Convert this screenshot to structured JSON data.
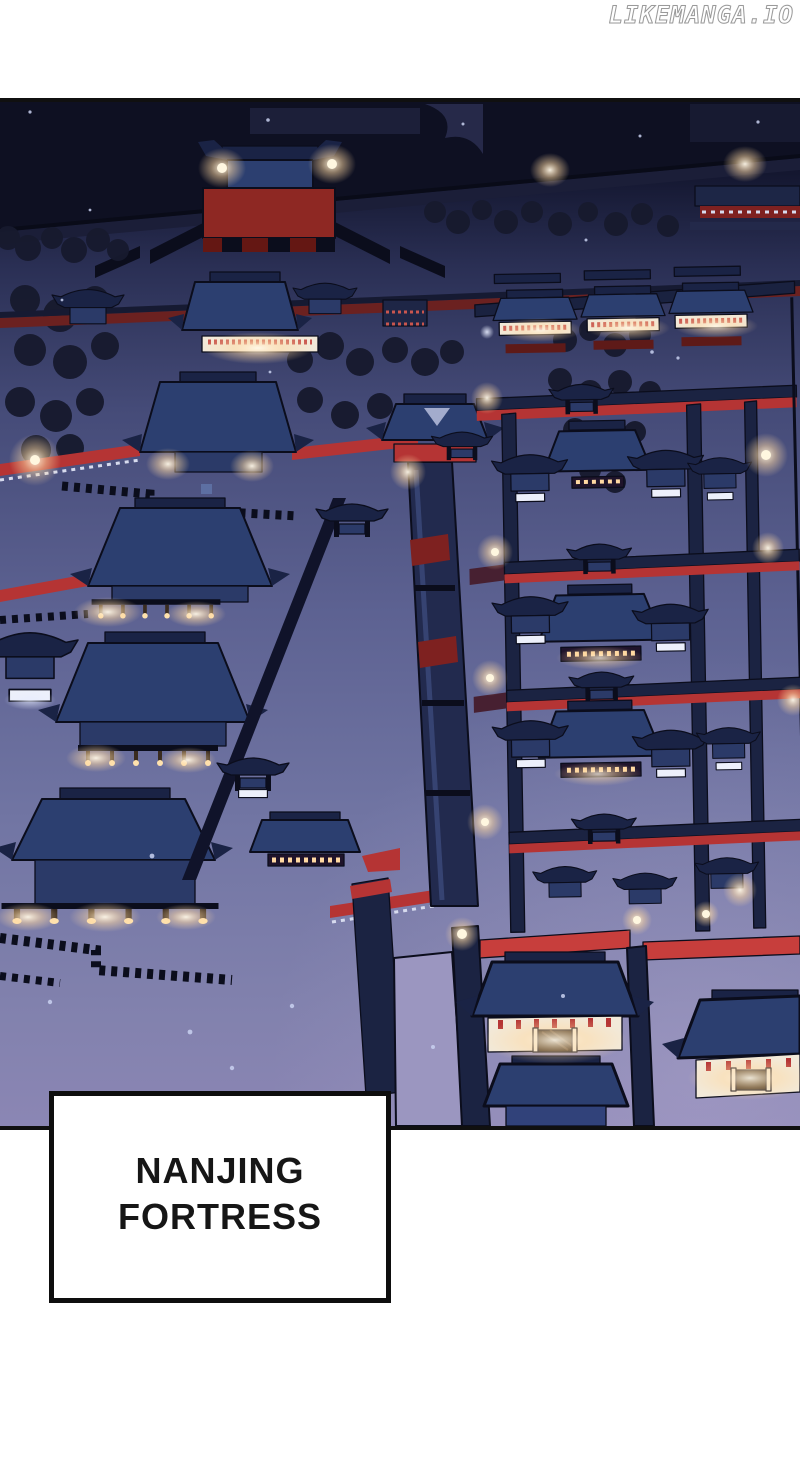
{
  "watermark": {
    "text": "LIKEMANGA.IO"
  },
  "panel": {
    "caption": {
      "line1": "NANJING",
      "line2": "FORTRESS"
    }
  },
  "colors": {
    "page_bg": "#ffffff",
    "panel_border": "#101010",
    "ink": "#0b0d1c",
    "sky_dark": "#0e1022",
    "ground_mid": "#5d6292",
    "ground_light": "#8b86b4",
    "roof_blue": "#2c3f70",
    "roof_dark": "#1a2345",
    "face_blue": "#2b3a68",
    "wall_navy": "#1b2342",
    "red_accent": "#b53434",
    "red_bright": "#c73e3c",
    "red_dark": "#7e2120",
    "red_dim": "#6b2120",
    "lamp_wall": "#f2e9d9",
    "lamp_glow": "#ffd9a2",
    "tree": "#171a2e",
    "snow": "#c9d1f0",
    "caption_ink": "#161616",
    "wm_fill": "#ffffff",
    "wm_outline": "#9a9a9a"
  }
}
